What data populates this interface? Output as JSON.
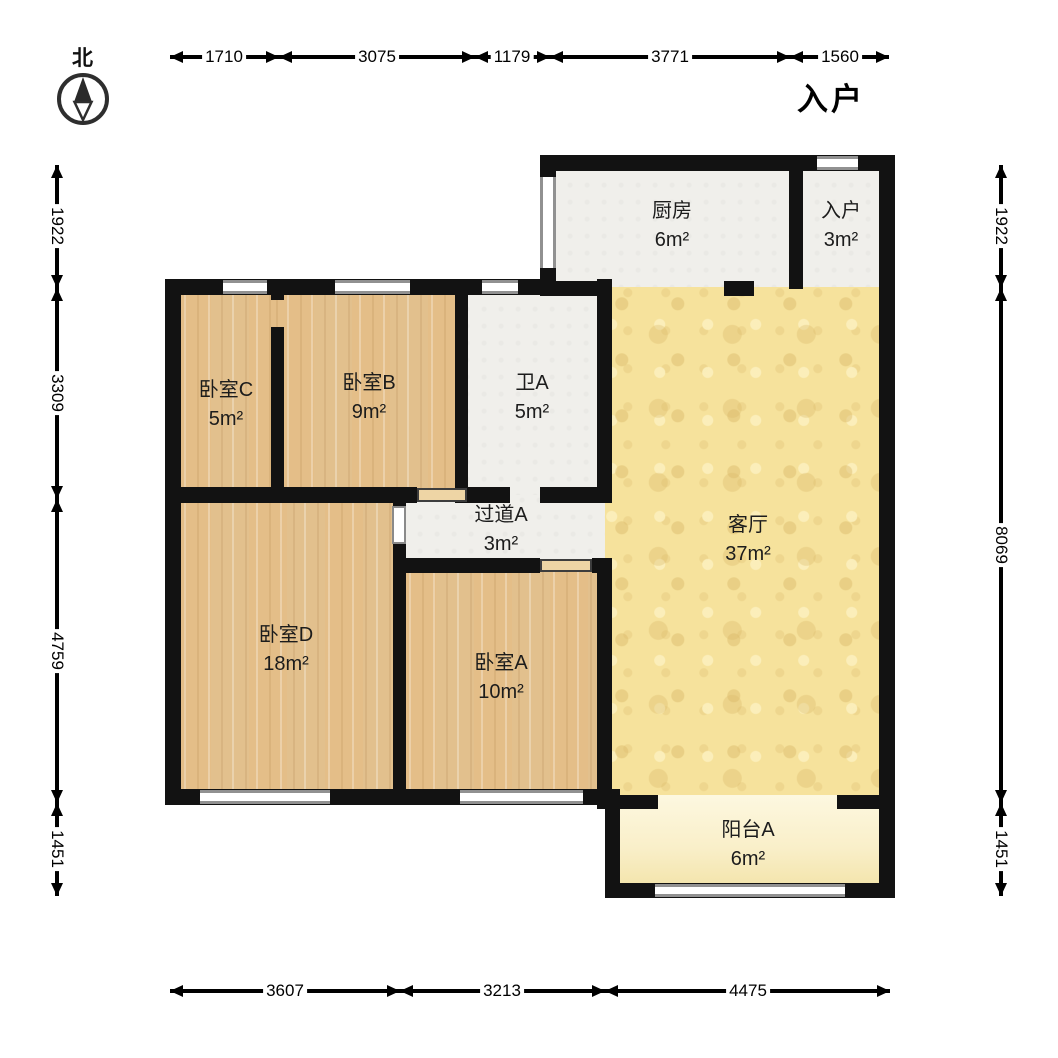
{
  "compass": {
    "label": "北"
  },
  "entry_marker": {
    "label": "入户"
  },
  "rooms": {
    "kitchen": {
      "name": "厨房",
      "area": "6m²"
    },
    "entry": {
      "name": "入户",
      "area": "3m²"
    },
    "bedroom_c": {
      "name": "卧室C",
      "area": "5m²"
    },
    "bedroom_b": {
      "name": "卧室B",
      "area": "9m²"
    },
    "bath_a": {
      "name": "卫A",
      "area": "5m²"
    },
    "hallway_a": {
      "name": "过道A",
      "area": "3m²"
    },
    "living": {
      "name": "客厅",
      "area": "37m²"
    },
    "bedroom_d": {
      "name": "卧室D",
      "area": "18m²"
    },
    "bedroom_a": {
      "name": "卧室A",
      "area": "10m²"
    },
    "balcony_a": {
      "name": "阳台A",
      "area": "6m²"
    }
  },
  "dimensions": {
    "top": [
      "1710",
      "3075",
      "1179",
      "3771",
      "1560"
    ],
    "bottom": [
      "3607",
      "3213",
      "4475"
    ],
    "left": [
      "1922",
      "3309",
      "4759",
      "1451"
    ],
    "right": [
      "1922",
      "8069",
      "1451"
    ]
  },
  "colors": {
    "wall": "#121212",
    "wood_floor": "#eac792",
    "living_floor": "#f6e29c",
    "balcony_floor": "#f8eec6",
    "tile_floor": "#f0efeb",
    "dimension_line": "#000000"
  }
}
